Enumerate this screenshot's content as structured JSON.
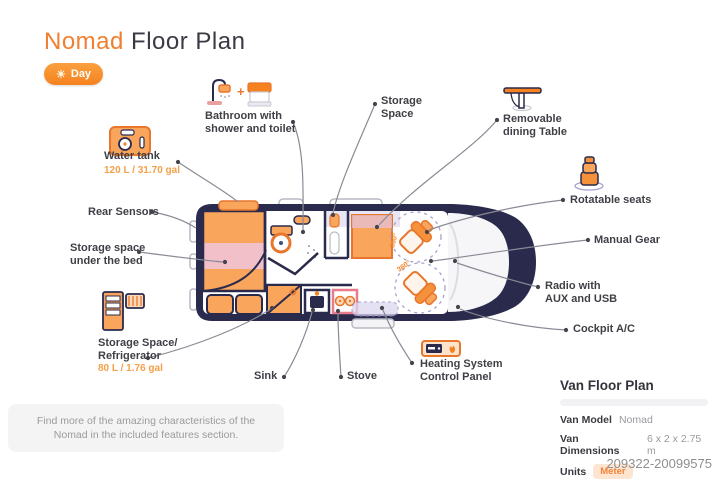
{
  "title": {
    "brand": "Nomad",
    "rest": " Floor Plan"
  },
  "mode_toggle": {
    "label": "Day",
    "icon": "sun"
  },
  "icons": {
    "sun": "☀",
    "plus": "+"
  },
  "callouts": {
    "bathroom": {
      "label": "Bathroom with shower and toilet"
    },
    "storage_space": {
      "label": "Storage Space"
    },
    "dining_table": {
      "label": "Removable dining Table"
    },
    "water_tank": {
      "label": "Water tank",
      "capacity": "120 L / 31.70 gal"
    },
    "rear_sensors": {
      "label": "Rear Sensors"
    },
    "under_bed": {
      "label": "Storage space under the bed"
    },
    "refrigerator": {
      "label": "Storage Space/ Refrigerator",
      "capacity": "80 L / 1.76 gal"
    },
    "sink": {
      "label": "Sink"
    },
    "stove": {
      "label": "Stove"
    },
    "heating": {
      "label": "Heating System Control Panel"
    },
    "rotatable_seats": {
      "label": "Rotatable seats"
    },
    "manual_gear": {
      "label": "Manual Gear"
    },
    "radio": {
      "label": "Radio with AUX and USB"
    },
    "cockpit_ac": {
      "label": "Cockpit A/C"
    }
  },
  "diagram": {
    "rotation_labels": [
      "360°",
      "360°"
    ]
  },
  "footer_note": "Find more of the amazing characteristics of the Nomad in the included features section.",
  "info_panel": {
    "heading": "Van Floor Plan",
    "rows": [
      {
        "label": "Van Model",
        "value": "Nomad"
      },
      {
        "label": "Van Dimensions",
        "value": "6 x 2 x 2.75 m"
      },
      {
        "label": "Units",
        "value": "Meter"
      }
    ]
  },
  "watermark_id": "209322-20099575",
  "colors": {
    "accent_orange": "#f5821f",
    "light_orange_fill": "#f9a55c",
    "navy": "#2a2a4d",
    "pink_band": "#f2c0c8",
    "lavender": "#d5cfec",
    "line_gray": "#8a8a96",
    "badge_bg": "#fde5d2"
  }
}
